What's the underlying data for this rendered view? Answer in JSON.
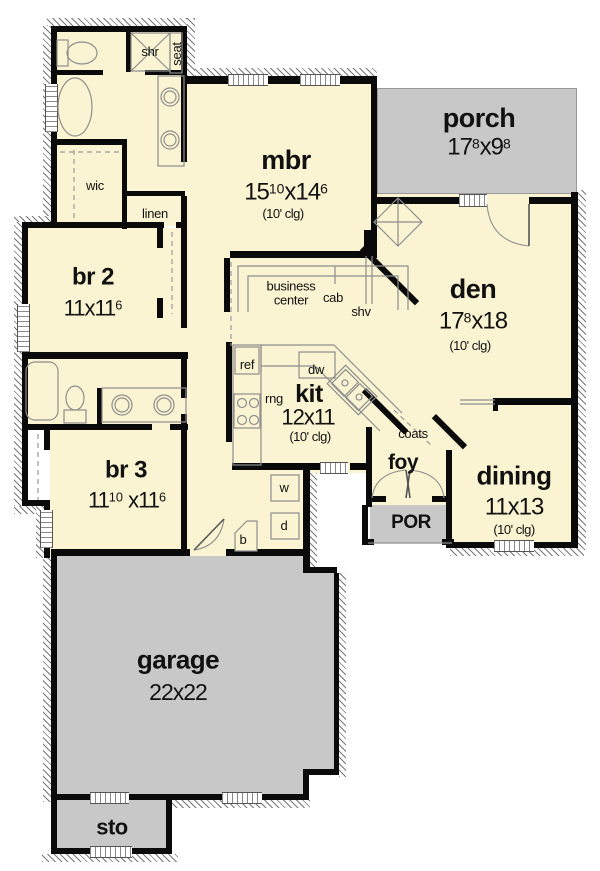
{
  "palette": {
    "room_fill": "#FAF4D2",
    "exterior_concrete_fill": "#C8C8C8",
    "wall_color": "#0A0A0A",
    "fixture_line_color": "#8E8E8E"
  },
  "rooms": {
    "mbr": {
      "name": "mbr",
      "d1": "15",
      "s1": "10",
      "d2": "x14",
      "s2": "6",
      "clg": "(10' clg)"
    },
    "porch": {
      "name": "porch",
      "d1": "17",
      "s1": "8",
      "d2": "x9",
      "s2": "8"
    },
    "br2": {
      "name": "br 2",
      "d1": "11x11",
      "s1": "6"
    },
    "den": {
      "name": "den",
      "d1": "17",
      "s1": "8",
      "d2": "x18",
      "clg": "(10' clg)"
    },
    "kit": {
      "name": "kit",
      "d1": "12x11",
      "clg": "(10' clg)"
    },
    "dining": {
      "name": "dining",
      "d1": "11x13",
      "clg": "(10' clg)"
    },
    "br3": {
      "name": "br 3",
      "d1": "11",
      "s1": "10",
      "d2": " x11",
      "s2": "6"
    },
    "garage": {
      "name": "garage",
      "d1": "22x22"
    },
    "foy": {
      "name": "foy"
    },
    "por": {
      "name": "POR"
    },
    "sto": {
      "name": "sto"
    }
  },
  "labels": {
    "shr": "shr",
    "seat": "seat",
    "wic": "wic",
    "linen": "linen",
    "business_line1": "business",
    "business_line2": "center",
    "cab": "cab",
    "shv": "shv",
    "ref": "ref",
    "dw": "dw",
    "rng": "rng",
    "coats": "coats",
    "washer": "w",
    "dryer": "d",
    "broom": "b"
  }
}
